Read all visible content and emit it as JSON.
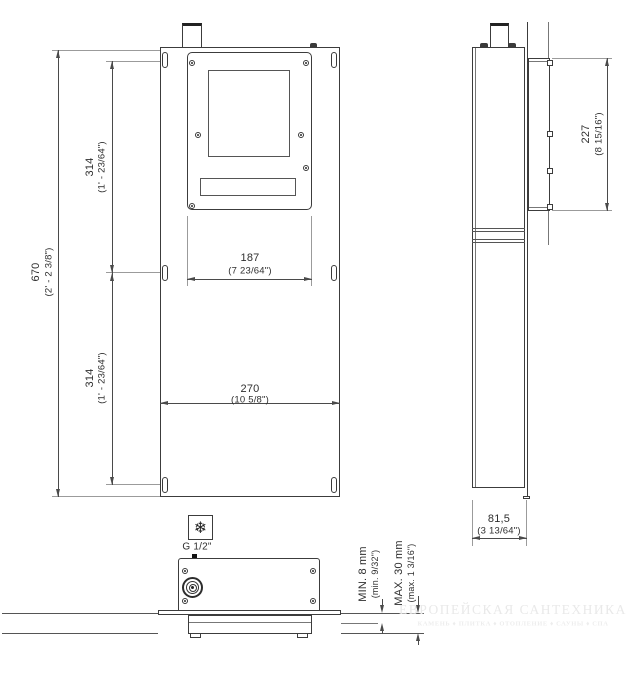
{
  "drawing": {
    "kind": "installation dimension drawing",
    "views": [
      "front",
      "side",
      "bottom"
    ]
  },
  "front": {
    "dim_height": {
      "mm": "670",
      "inch": "(2' - 2 3/8\")"
    },
    "dim_upper": {
      "mm": "314",
      "inch": "(1' - 23/64\")"
    },
    "dim_lower": {
      "mm": "314",
      "inch": "(1' - 23/64\")"
    },
    "dim_plate_width": {
      "mm": "187",
      "inch": "(7 23/64\")"
    },
    "dim_panel_width": {
      "mm": "270",
      "inch": "(10 5/8\")"
    }
  },
  "side": {
    "dim_plate_height": {
      "mm": "227",
      "inch": "(8 15/16\")"
    },
    "dim_depth": {
      "mm": "81,5",
      "inch": "(3 13/64\")"
    }
  },
  "bottom": {
    "connection": {
      "label": "G 1/2\"",
      "cold_symbol": "❄"
    },
    "wall_min": {
      "label": "MIN. 8 mm",
      "inch": "(min. 9/32\")"
    },
    "wall_max": {
      "label": "MAX. 30 mm",
      "inch": "(max. 1 3/16\")"
    }
  },
  "watermark": {
    "line1": "ЕВРОПЕЙСКАЯ САНТЕХНИКА",
    "line2": "КАМЕНЬ ♦ ПЛИТКА ♦ ОТОПЛЕНИЕ ♦ САУНЫ ♦ СПА"
  },
  "colors": {
    "line": "#3c3c3c",
    "dim": "#4a4a4a",
    "extension": "#9b9b9b",
    "watermark": "#e9e9e9"
  }
}
